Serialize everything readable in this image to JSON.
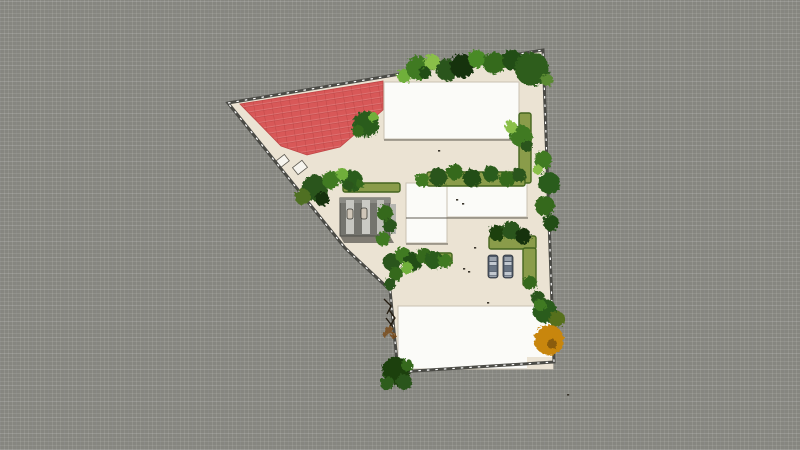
{
  "app": {
    "title": "3d-home-plan-aerial-view",
    "visible_text": []
  },
  "canvas": {
    "width": 800,
    "height": 450
  },
  "colors": {
    "background": "#868680",
    "ground": "#ebe3d3",
    "boundary": "#4a4a45",
    "fence_dash": "#ffffff",
    "roof_white": "#fbfbf8",
    "roof_edge": "#c9c2b2",
    "roof_red": "#d85858",
    "roof_red_line": "#bf4747",
    "hedge_fill": "#8a9c4a",
    "hedge_edge": "#44651f",
    "shadow": "rgba(80,76,66,0.45)",
    "structure_base": "#74746e",
    "structure_edge": "#4e4e48",
    "car_body": "#515b69",
    "car_glass": "#c3c9d0",
    "car_roof": "#6a7583",
    "car_metal": "#9aa2ac",
    "twig": "#241c10",
    "dead_leaves": "#7a4a14",
    "speck": "#3a352c"
  },
  "scene": {
    "site": {
      "outline": [
        [
          228,
          103
        ],
        [
          543,
          50
        ],
        [
          554,
          362
        ],
        [
          398,
          372
        ],
        [
          390,
          290
        ],
        [
          345,
          248
        ]
      ]
    },
    "red_roof": {
      "points": [
        [
          240,
          104
        ],
        [
          383,
          81
        ],
        [
          383,
          110
        ],
        [
          340,
          147
        ],
        [
          307,
          155
        ],
        [
          281,
          146
        ]
      ]
    },
    "buildings": [
      {
        "name": "north-building-roof",
        "x": 384,
        "y": 82,
        "w": 135,
        "h": 57
      },
      {
        "name": "middle-building-roof",
        "x": 406,
        "y": 183,
        "w": 121,
        "h": 34
      },
      {
        "name": "middle-building-wing-roof",
        "x": 406,
        "y": 183,
        "w": 41,
        "h": 60
      },
      {
        "name": "south-building-roof",
        "x": 398,
        "y": 306,
        "w": 155,
        "h": 63
      }
    ],
    "ground_notches": [
      {
        "x": 527,
        "y": 357,
        "w": 26,
        "h": 12
      }
    ],
    "shadow_lines": [
      {
        "x": 384,
        "y": 139,
        "w": 136,
        "h": 2
      },
      {
        "x": 406,
        "y": 217,
        "w": 122,
        "h": 2
      },
      {
        "x": 406,
        "y": 243,
        "w": 42,
        "h": 2
      }
    ],
    "structure": {
      "x": 340,
      "y": 198,
      "w": 50,
      "h": 38,
      "top_strip_h": 5,
      "panels": [
        {
          "x": 346,
          "w": 8,
          "c": "#c6c6c0"
        },
        {
          "x": 362,
          "w": 8,
          "c": "#cacac4"
        },
        {
          "x": 377,
          "w": 7,
          "c": "#bebeb8"
        }
      ],
      "figures": [
        {
          "x": 347,
          "y": 209,
          "w": 6,
          "h": 10
        },
        {
          "x": 361,
          "y": 208,
          "w": 6,
          "h": 11
        }
      ],
      "step": {
        "x": 390,
        "y": 204,
        "w": 6,
        "h": 30,
        "c": "#b5b5af"
      },
      "shadow": [
        [
          340,
          236
        ],
        [
          390,
          236
        ],
        [
          394,
          243
        ],
        [
          344,
          243
        ]
      ]
    },
    "hedges": [
      {
        "name": "hedge-east-vertical",
        "x": 519,
        "y": 113,
        "w": 12,
        "h": 70
      },
      {
        "name": "hedge-mid-horizontal",
        "x": 427,
        "y": 172,
        "w": 98,
        "h": 14
      },
      {
        "name": "hedge-structure-top",
        "x": 343,
        "y": 183,
        "w": 57,
        "h": 9
      },
      {
        "name": "hedge-parking-top",
        "x": 489,
        "y": 236,
        "w": 47,
        "h": 13
      },
      {
        "name": "hedge-parking-vertical",
        "x": 523,
        "y": 248,
        "w": 13,
        "h": 38
      },
      {
        "name": "hedge-mid-small",
        "x": 426,
        "y": 253,
        "w": 26,
        "h": 11
      }
    ],
    "cars": [
      {
        "x": 488,
        "y": 255
      },
      {
        "x": 503,
        "y": 255
      }
    ],
    "car_size": {
      "w": 10,
      "h": 23
    },
    "gates": [
      {
        "x": 277,
        "y": 157,
        "w": 11,
        "h": 8,
        "rot": -38
      },
      {
        "x": 294,
        "y": 163,
        "w": 12,
        "h": 9,
        "rot": -38
      }
    ],
    "trees": [
      {
        "x": 404,
        "y": 76,
        "r": 7,
        "c": "#6faf3a"
      },
      {
        "x": 418,
        "y": 68,
        "r": 12,
        "c": "#3f7a22"
      },
      {
        "x": 432,
        "y": 62,
        "r": 8,
        "c": "#8abf4a"
      },
      {
        "x": 447,
        "y": 70,
        "r": 11,
        "c": "#2c541a"
      },
      {
        "x": 462,
        "y": 66,
        "r": 12,
        "c": "#17300e"
      },
      {
        "x": 477,
        "y": 59,
        "r": 9,
        "c": "#4a8a28"
      },
      {
        "x": 494,
        "y": 63,
        "r": 11,
        "c": "#356b1d"
      },
      {
        "x": 512,
        "y": 60,
        "r": 10,
        "c": "#244e14"
      },
      {
        "x": 532,
        "y": 69,
        "r": 17,
        "c": "#2d5d1b"
      },
      {
        "x": 547,
        "y": 80,
        "r": 6,
        "c": "#5a8a30"
      },
      {
        "x": 425,
        "y": 73,
        "r": 6,
        "c": "#244e14"
      },
      {
        "x": 543,
        "y": 160,
        "r": 9,
        "c": "#3f7a22"
      },
      {
        "x": 549,
        "y": 183,
        "r": 11,
        "c": "#2c5c1a"
      },
      {
        "x": 545,
        "y": 206,
        "r": 10,
        "c": "#35691f"
      },
      {
        "x": 551,
        "y": 223,
        "r": 8,
        "c": "#244e14"
      },
      {
        "x": 538,
        "y": 170,
        "r": 5,
        "c": "#8abf4a"
      },
      {
        "x": 521,
        "y": 136,
        "r": 11,
        "c": "#3f7a22"
      },
      {
        "x": 511,
        "y": 127,
        "r": 6,
        "c": "#8abf4a"
      },
      {
        "x": 527,
        "y": 146,
        "r": 6,
        "c": "#2c541a"
      },
      {
        "x": 366,
        "y": 124,
        "r": 13,
        "c": "#2c5c1a"
      },
      {
        "x": 373,
        "y": 117,
        "r": 5,
        "c": "#6faf3a"
      },
      {
        "x": 358,
        "y": 131,
        "r": 6,
        "c": "#35691f"
      },
      {
        "x": 315,
        "y": 188,
        "r": 13,
        "c": "#2c541a"
      },
      {
        "x": 303,
        "y": 197,
        "r": 8,
        "c": "#4f7020"
      },
      {
        "x": 331,
        "y": 180,
        "r": 9,
        "c": "#3f7a22"
      },
      {
        "x": 352,
        "y": 181,
        "r": 11,
        "c": "#2c5c1a"
      },
      {
        "x": 342,
        "y": 174,
        "r": 6,
        "c": "#6faf3a"
      },
      {
        "x": 322,
        "y": 199,
        "r": 7,
        "c": "#17300e"
      },
      {
        "x": 385,
        "y": 213,
        "r": 8,
        "c": "#35691f"
      },
      {
        "x": 390,
        "y": 226,
        "r": 7,
        "c": "#2c541a"
      },
      {
        "x": 383,
        "y": 239,
        "r": 7,
        "c": "#3f7a22"
      },
      {
        "x": 438,
        "y": 177,
        "r": 9,
        "c": "#2c541a"
      },
      {
        "x": 455,
        "y": 172,
        "r": 8,
        "c": "#35691f"
      },
      {
        "x": 472,
        "y": 178,
        "r": 9,
        "c": "#244e14"
      },
      {
        "x": 491,
        "y": 174,
        "r": 8,
        "c": "#2c5c1a"
      },
      {
        "x": 507,
        "y": 179,
        "r": 8,
        "c": "#35691f"
      },
      {
        "x": 519,
        "y": 175,
        "r": 7,
        "c": "#2c541a"
      },
      {
        "x": 422,
        "y": 180,
        "r": 7,
        "c": "#3f7a22"
      },
      {
        "x": 349,
        "y": 186,
        "r": 5,
        "c": "#2c541a"
      },
      {
        "x": 360,
        "y": 184,
        "r": 4,
        "c": "#35691f"
      },
      {
        "x": 392,
        "y": 262,
        "r": 9,
        "c": "#2c541a"
      },
      {
        "x": 403,
        "y": 255,
        "r": 8,
        "c": "#3f7a22"
      },
      {
        "x": 413,
        "y": 262,
        "r": 9,
        "c": "#244e14"
      },
      {
        "x": 424,
        "y": 256,
        "r": 8,
        "c": "#35691f"
      },
      {
        "x": 434,
        "y": 260,
        "r": 9,
        "c": "#2c5c1a"
      },
      {
        "x": 445,
        "y": 261,
        "r": 7,
        "c": "#3f7a22"
      },
      {
        "x": 396,
        "y": 274,
        "r": 7,
        "c": "#35691f"
      },
      {
        "x": 390,
        "y": 284,
        "r": 6,
        "c": "#2c541a"
      },
      {
        "x": 407,
        "y": 268,
        "r": 6,
        "c": "#6faf3a"
      },
      {
        "x": 497,
        "y": 233,
        "r": 8,
        "c": "#1d4010"
      },
      {
        "x": 511,
        "y": 230,
        "r": 9,
        "c": "#2c541a"
      },
      {
        "x": 523,
        "y": 236,
        "r": 8,
        "c": "#17300e"
      },
      {
        "x": 530,
        "y": 283,
        "r": 7,
        "c": "#35691f"
      },
      {
        "x": 396,
        "y": 371,
        "r": 14,
        "c": "#1d4010"
      },
      {
        "x": 404,
        "y": 382,
        "r": 8,
        "c": "#2c541a"
      },
      {
        "x": 387,
        "y": 383,
        "r": 7,
        "c": "#2d5d1b"
      },
      {
        "x": 407,
        "y": 365,
        "r": 6,
        "c": "#35691f"
      },
      {
        "x": 538,
        "y": 298,
        "r": 7,
        "c": "#2c541a"
      },
      {
        "x": 545,
        "y": 311,
        "r": 12,
        "c": "#2c5c1a"
      },
      {
        "x": 557,
        "y": 319,
        "r": 8,
        "c": "#56701c"
      },
      {
        "x": 549,
        "y": 340,
        "r": 15,
        "c": "#c8860a"
      },
      {
        "x": 552,
        "y": 344,
        "r": 5,
        "c": "#8a5c08"
      },
      {
        "x": 540,
        "y": 305,
        "r": 6,
        "c": "#3f7a22"
      }
    ],
    "twigs": [
      [
        [
          384,
          299
        ],
        [
          391,
          306
        ],
        [
          387,
          314
        ]
      ],
      [
        [
          389,
          310
        ],
        [
          395,
          318
        ],
        [
          390,
          326
        ]
      ],
      [
        [
          386,
          318
        ],
        [
          393,
          327
        ]
      ]
    ],
    "dead_leaf_dots": [
      [
        389,
        330,
        4
      ],
      [
        394,
        336,
        3
      ],
      [
        385,
        335,
        2.5
      ]
    ],
    "specks": [
      [
        456,
        199
      ],
      [
        462,
        203
      ],
      [
        463,
        268
      ],
      [
        468,
        271
      ],
      [
        474,
        247
      ],
      [
        487,
        302
      ],
      [
        438,
        150
      ],
      [
        567,
        394
      ],
      [
        528,
        280
      ]
    ]
  }
}
